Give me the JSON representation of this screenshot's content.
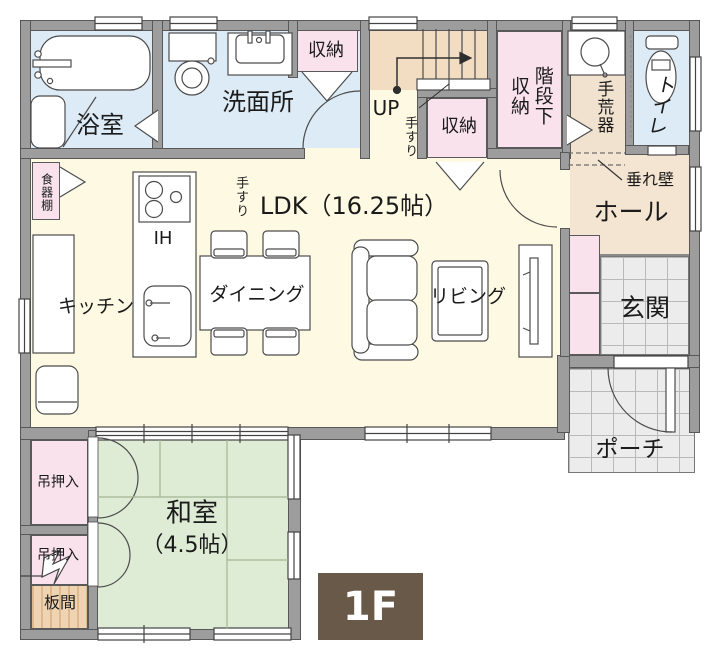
{
  "floor_plan": {
    "floor_badge": "1F",
    "labels": {
      "bath": "浴室",
      "washroom": "洗面所",
      "storage_top": "収納",
      "storage_mid": "収納",
      "understair_storage": "階段下収納",
      "handwash": "手荒器",
      "toilet": "トイレ",
      "hanging_wall": "垂れ壁",
      "hall": "ホール",
      "entrance": "玄関",
      "porch": "ポーチ",
      "handrail_ldk": "手すり",
      "ldk": "LDK（16.25帖）",
      "kitchen": "キッチン",
      "ih_cooktop": "IH",
      "dining": "ダイニング",
      "living": "リビング",
      "stairs_up": "UP",
      "handrail_stairs": "手すり",
      "japanese_room": "和室",
      "japanese_room_size": "（4.5帖）",
      "closet_upper": "吊押入",
      "closet_lower": "吊押入",
      "wood_floor": "板間",
      "cupboard": "食器棚"
    },
    "colors": {
      "wall_grey": "#9d9d9d",
      "wet_area_blue": "#dcebf6",
      "storage_pink": "#f9e2ec",
      "stairs_tan": "#f2dcc2",
      "hall_beige": "#f4e5d2",
      "ldk_cream": "#fdf9e3",
      "tatami_green": "#deebd5",
      "tile_grey": "#ececec",
      "wood_tan": "#eed4b3",
      "badge_brown": "#695949"
    }
  }
}
